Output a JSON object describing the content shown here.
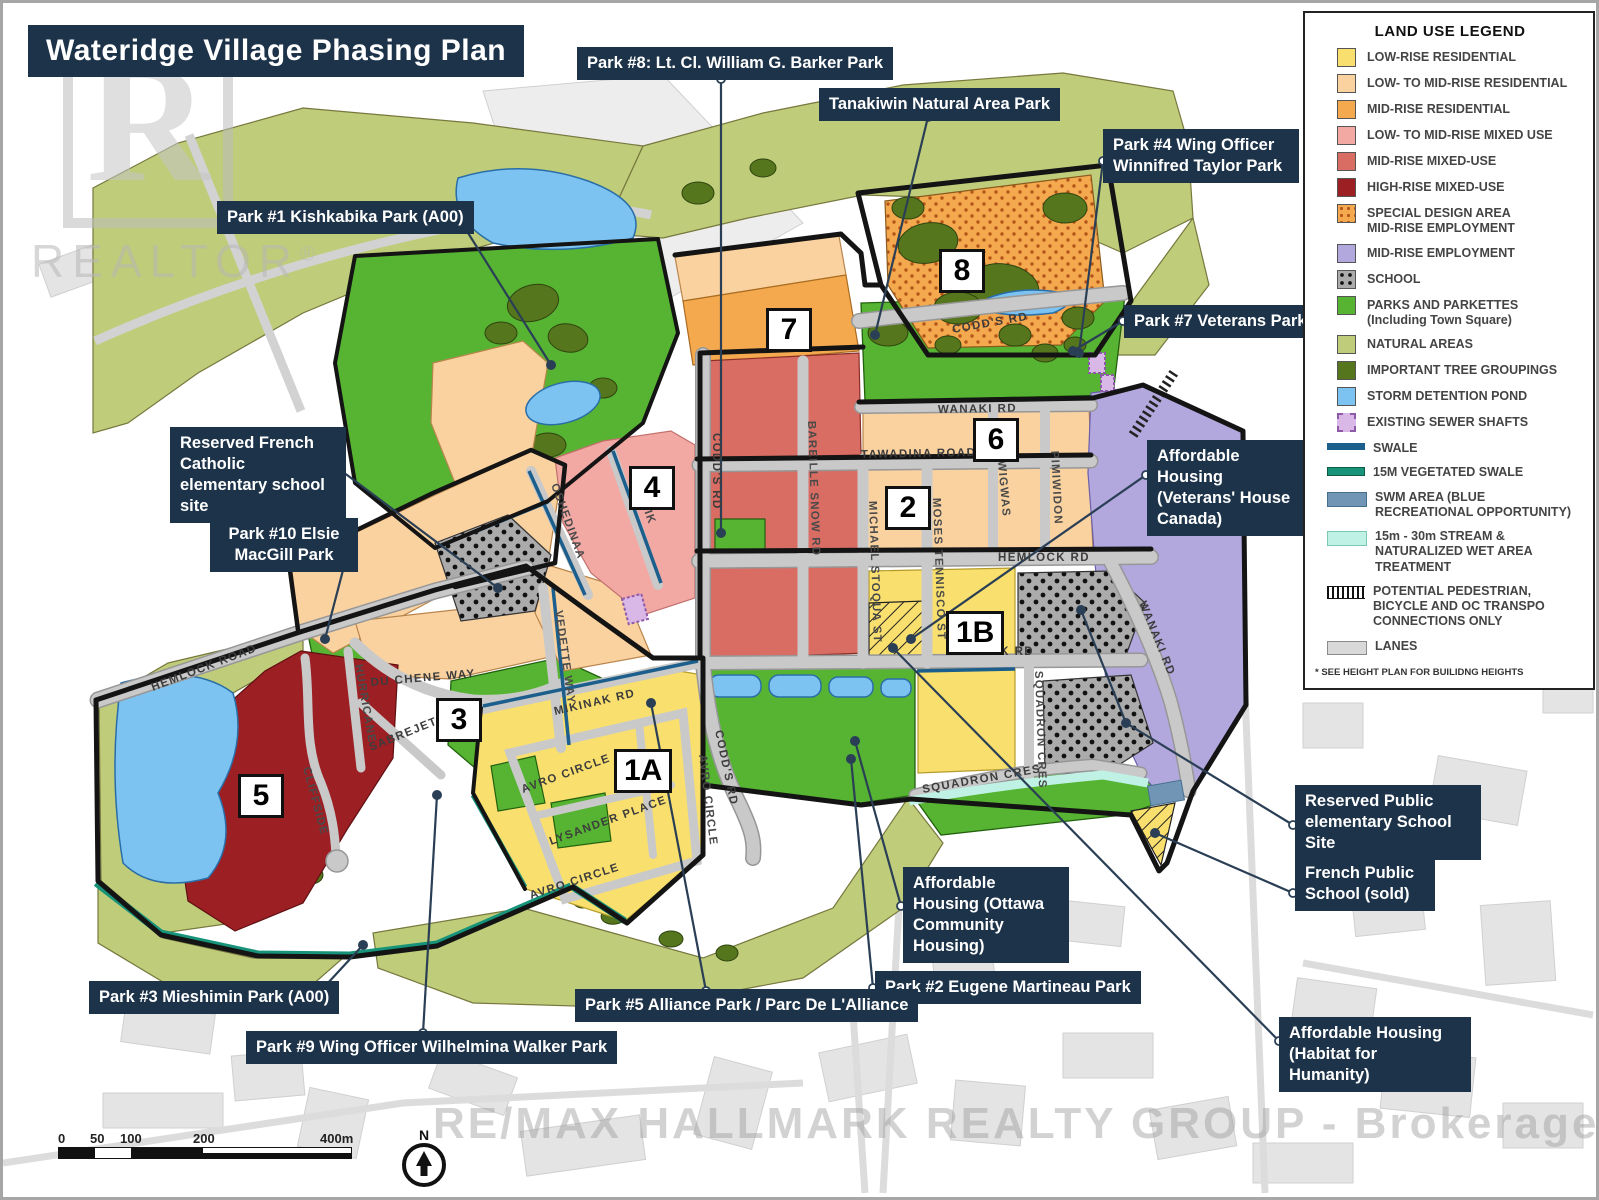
{
  "title": "Wateridge Village Phasing Plan",
  "watermark": {
    "logo_text": "REALTOR",
    "reg": "®",
    "bottom": "RE/MAX HALLMARK REALTY GROUP - Brokerage"
  },
  "legend": {
    "title": "LAND USE LEGEND",
    "footnote": "* SEE HEIGHT PLAN FOR BUILIDNG HEIGHTS",
    "items": [
      {
        "label": "LOW-RISE RESIDENTIAL",
        "color": "#F9E06E"
      },
      {
        "label": "LOW- TO MID-RISE RESIDENTIAL",
        "color": "#FAD2A0"
      },
      {
        "label": "MID-RISE RESIDENTIAL",
        "color": "#F5A94E"
      },
      {
        "label": "LOW- TO MID-RISE MIXED USE",
        "color": "#F2A9A4"
      },
      {
        "label": "MID-RISE MIXED-USE",
        "color": "#D96C63"
      },
      {
        "label": "HIGH-RISE MIXED-USE",
        "color": "#9C1F24"
      },
      {
        "label": "SPECIAL DESIGN AREA\nMID-RISE EMPLOYMENT",
        "color": "#F5A94E"
      },
      {
        "label": "MID-RISE EMPLOYMENT",
        "color": "#B3A8DD"
      },
      {
        "label": "SCHOOL",
        "color": "#ABABAB"
      },
      {
        "label": "PARKS AND PARKETTES\n(Including Town Square)",
        "color": "#56B432"
      },
      {
        "label": "NATURAL AREAS",
        "color": "#BFCC79"
      },
      {
        "label": "IMPORTANT TREE GROUPINGS",
        "color": "#55761C"
      },
      {
        "label": "STORM DETENTION POND",
        "color": "#7CC3F2"
      },
      {
        "label": "EXISTING SEWER SHAFTS",
        "color": "#D9B8E8"
      },
      {
        "label": "SWALE",
        "color": "#1C5F8C"
      },
      {
        "label": "15M VEGETATED SWALE",
        "color": "#17937A"
      },
      {
        "label": "SWM AREA (BLUE\nRECREATIONAL OPPORTUNITY)",
        "color": "#7195B5"
      },
      {
        "label": "15m - 30m STREAM &\nNATURALIZED WET AREA\nTREATMENT",
        "color": "#BFF2E4"
      },
      {
        "label": "POTENTIAL PEDESTRIAN,\nBICYCLE AND OC TRANSPO\nCONNECTIONS ONLY",
        "color": "#111111"
      },
      {
        "label": "LANES",
        "color": "#D9D9D9"
      }
    ]
  },
  "phases": [
    {
      "label": "1A"
    },
    {
      "label": "1B"
    },
    {
      "label": "2"
    },
    {
      "label": "3"
    },
    {
      "label": "4"
    },
    {
      "label": "5"
    },
    {
      "label": "6"
    },
    {
      "label": "7"
    },
    {
      "label": "8"
    }
  ],
  "callouts": [
    {
      "text": "Park #1 Kishkabika Park (A00)"
    },
    {
      "text": "Park #8: Lt. Cl. William G. Barker Park"
    },
    {
      "text": "Tanakiwin Natural Area Park"
    },
    {
      "text": "Park #4 Wing Officer Winnifred Taylor Park"
    },
    {
      "text": "Park #7 Veterans Park"
    },
    {
      "text": "Reserved French Catholic elementary school site"
    },
    {
      "text": "Park #10 Elsie MacGill Park"
    },
    {
      "text": "Affordable Housing (Veterans' House Canada)"
    },
    {
      "text": "Reserved Public elementary School Site"
    },
    {
      "text": "French Public School (sold)"
    },
    {
      "text": "Affordable Housing (Ottawa Community Housing)"
    },
    {
      "text": "Park #2 Eugene Martineau Park"
    },
    {
      "text": "Park #5 Alliance Park / Parc De L'Alliance"
    },
    {
      "text": "Park #3 Mieshimin Park (A00)"
    },
    {
      "text": "Park #9 Wing Officer Wilhelmina Walker Park"
    },
    {
      "text": "Affordable Housing (Habitat for Humanity)"
    }
  ],
  "streets": [
    {
      "name": "CODD'S RD"
    },
    {
      "name": "CODD'S RD"
    },
    {
      "name": "CODD'S RD"
    },
    {
      "name": "WANAKI RD"
    },
    {
      "name": "WANAKI RD"
    },
    {
      "name": "TAWADINA ROAD"
    },
    {
      "name": "HEMLOCK RD"
    },
    {
      "name": "HEMLOCK ROAD"
    },
    {
      "name": "MIKINAK RD"
    },
    {
      "name": "MIKINAK RD"
    },
    {
      "name": "BAREILLE SNOW RD"
    },
    {
      "name": "MICHAEL STOQUA ST"
    },
    {
      "name": "MOSES TENNISCO ST"
    },
    {
      "name": "WIGWAS"
    },
    {
      "name": "PIMIWIDON"
    },
    {
      "name": "SQUADRON CRES"
    },
    {
      "name": "SQUADRON CRES"
    },
    {
      "name": "OSHEDINAA"
    },
    {
      "name": "WINISIK"
    },
    {
      "name": "DU CHENE WAY"
    },
    {
      "name": "HURRICANE"
    },
    {
      "name": "SABREJET"
    },
    {
      "name": "VEDETTE WAY"
    },
    {
      "name": "CLIFFSIDE"
    },
    {
      "name": "AVRO CIRCLE"
    },
    {
      "name": "AVRO CIRCLE"
    },
    {
      "name": "AVRO CIRCLE"
    },
    {
      "name": "LYSANDER PLACE"
    }
  ],
  "scalebar": {
    "ticks": [
      "0",
      "50",
      "100",
      "200",
      "400m"
    ],
    "north_label": "N"
  },
  "colors": {
    "callout_bg": "#1d3349",
    "title_bg": "#1d3349",
    "road": "#c9c9c9",
    "boundary": "#141414"
  }
}
